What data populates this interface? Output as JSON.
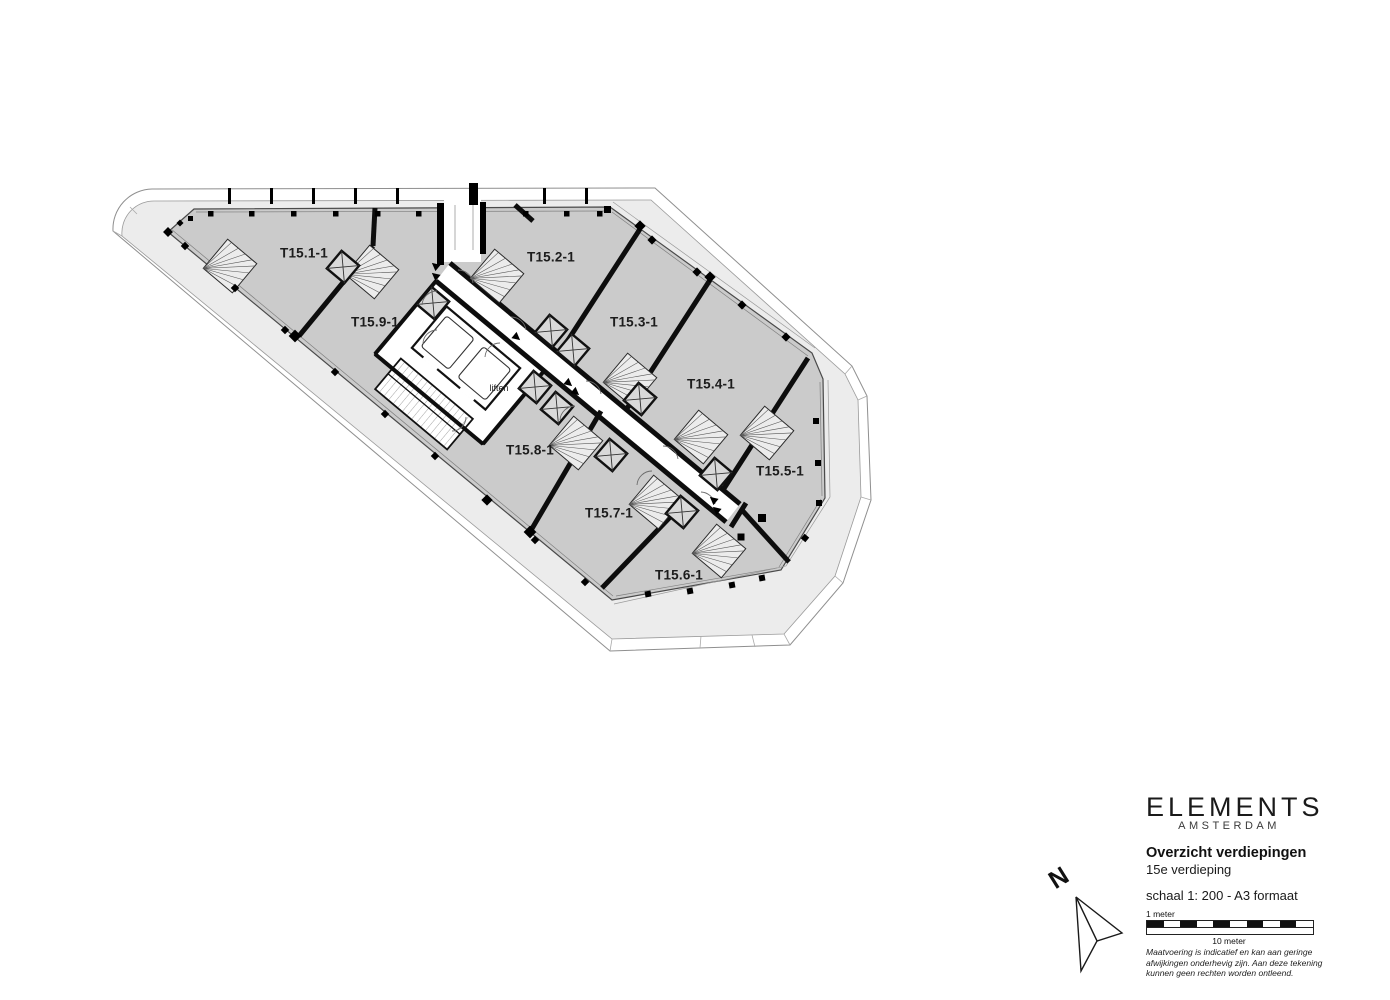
{
  "colors": {
    "background": "#ffffff",
    "floor_plate": "#cbcbcb",
    "terrace": "#ececec",
    "wall": "#0d0d0d",
    "plate_outline": "#4a4a4a"
  },
  "plan": {
    "units": [
      {
        "label": "T15.1-1",
        "x": 304,
        "y": 253
      },
      {
        "label": "T15.2-1",
        "x": 551,
        "y": 257
      },
      {
        "label": "T15.3-1",
        "x": 634,
        "y": 322
      },
      {
        "label": "T15.4-1",
        "x": 711,
        "y": 384
      },
      {
        "label": "T15.5-1",
        "x": 780,
        "y": 471
      },
      {
        "label": "T15.6-1",
        "x": 679,
        "y": 575
      },
      {
        "label": "T15.7-1",
        "x": 609,
        "y": 513
      },
      {
        "label": "T15.8-1",
        "x": 530,
        "y": 450
      },
      {
        "label": "T15.9-1",
        "x": 375,
        "y": 322
      }
    ],
    "core_label": "liften"
  },
  "north": {
    "label": "N"
  },
  "title_block": {
    "brand": "ELEMENTS",
    "brand_sub": "AMSTERDAM",
    "heading": "Overzicht verdiepingen",
    "subheading": "15e verdieping",
    "scale_note": "schaal 1: 200 - A3 formaat",
    "scale_bar": {
      "label_top": "1 meter",
      "label_bottom": "10 meter",
      "segments": 10
    },
    "disclaimer_lines": [
      "Maatvoering is indicatief en kan aan geringe",
      "afwijkingen onderhevig zijn. Aan deze tekening",
      "kunnen geen rechten worden ontleend."
    ]
  }
}
